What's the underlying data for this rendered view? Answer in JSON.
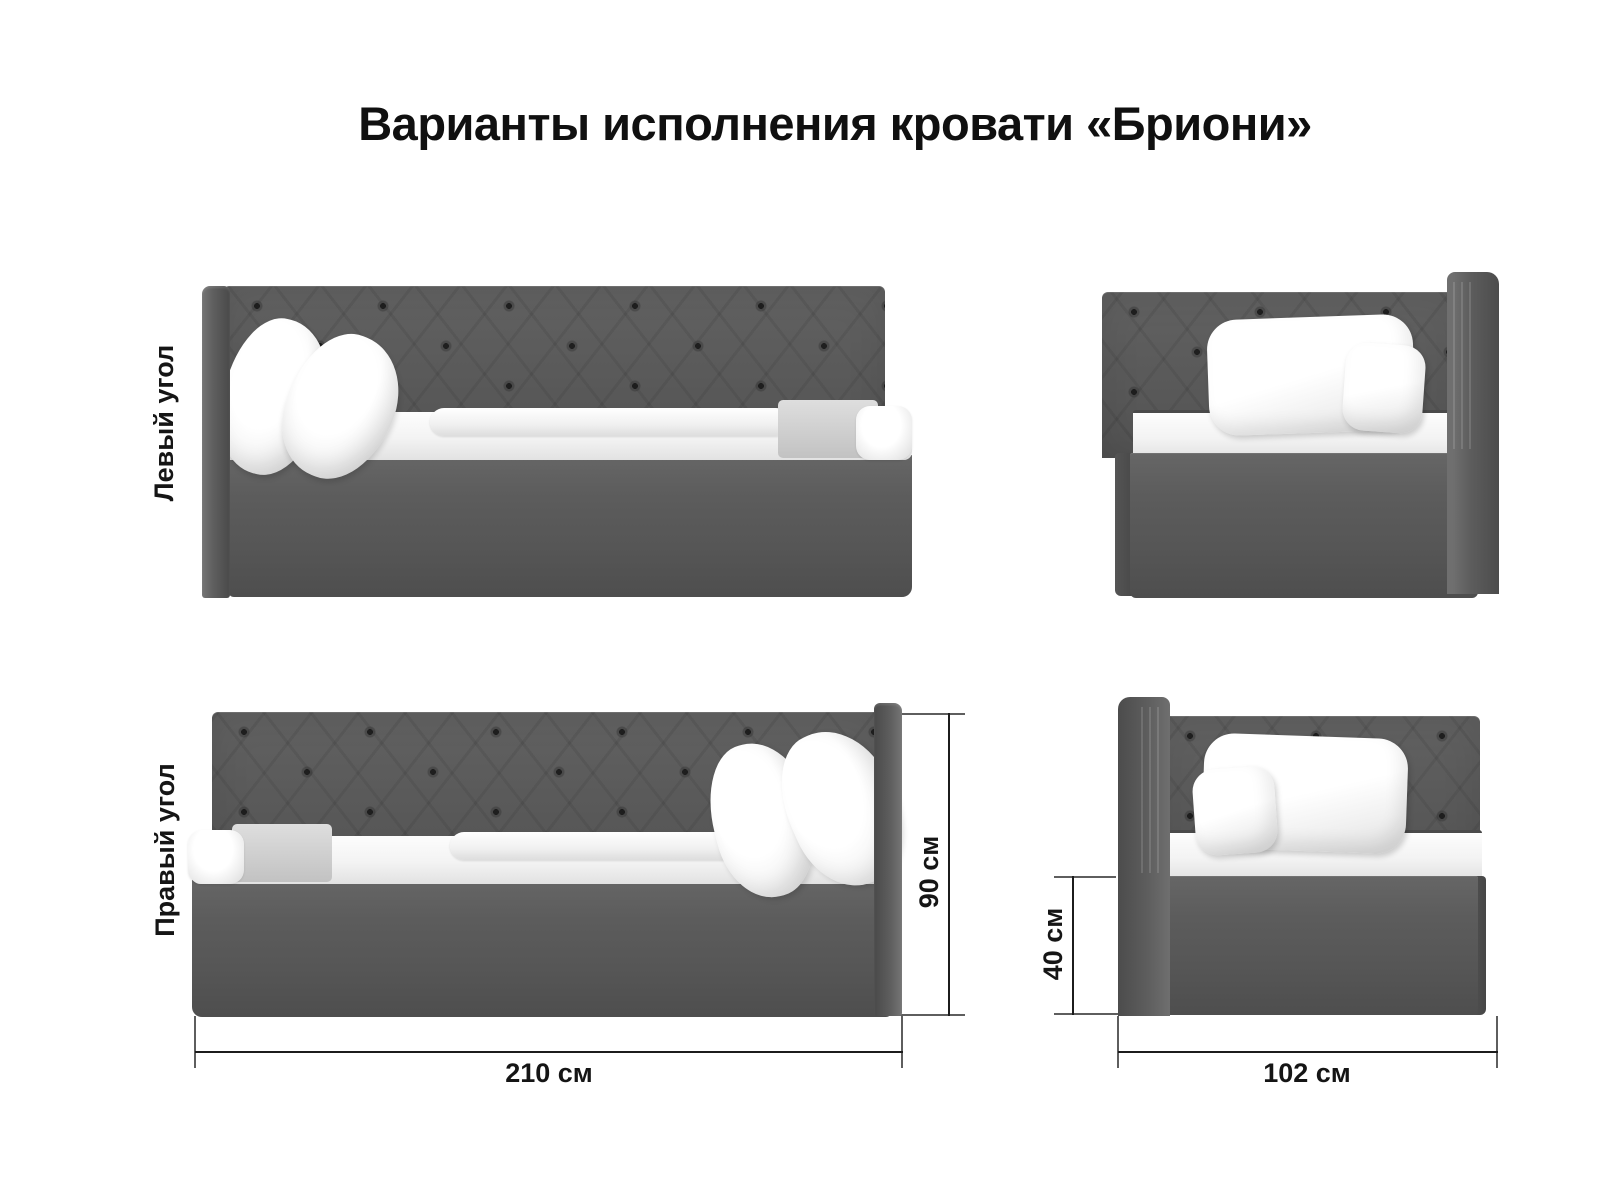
{
  "title": "Варианты исполнения кровати «Бриони»",
  "variants": {
    "left_corner": {
      "label": "Левый угол"
    },
    "right_corner": {
      "label": "Правый угол"
    }
  },
  "dimensions": {
    "length": "210 см",
    "height": "90 см",
    "base_height": "40 см",
    "width": "102 см"
  },
  "colors": {
    "upholstery_gray": "#5a5a5a",
    "bedding_white": "#f5f5f5",
    "text": "#151515",
    "dimension_line": "#1c1c1c",
    "background": "#ffffff"
  }
}
